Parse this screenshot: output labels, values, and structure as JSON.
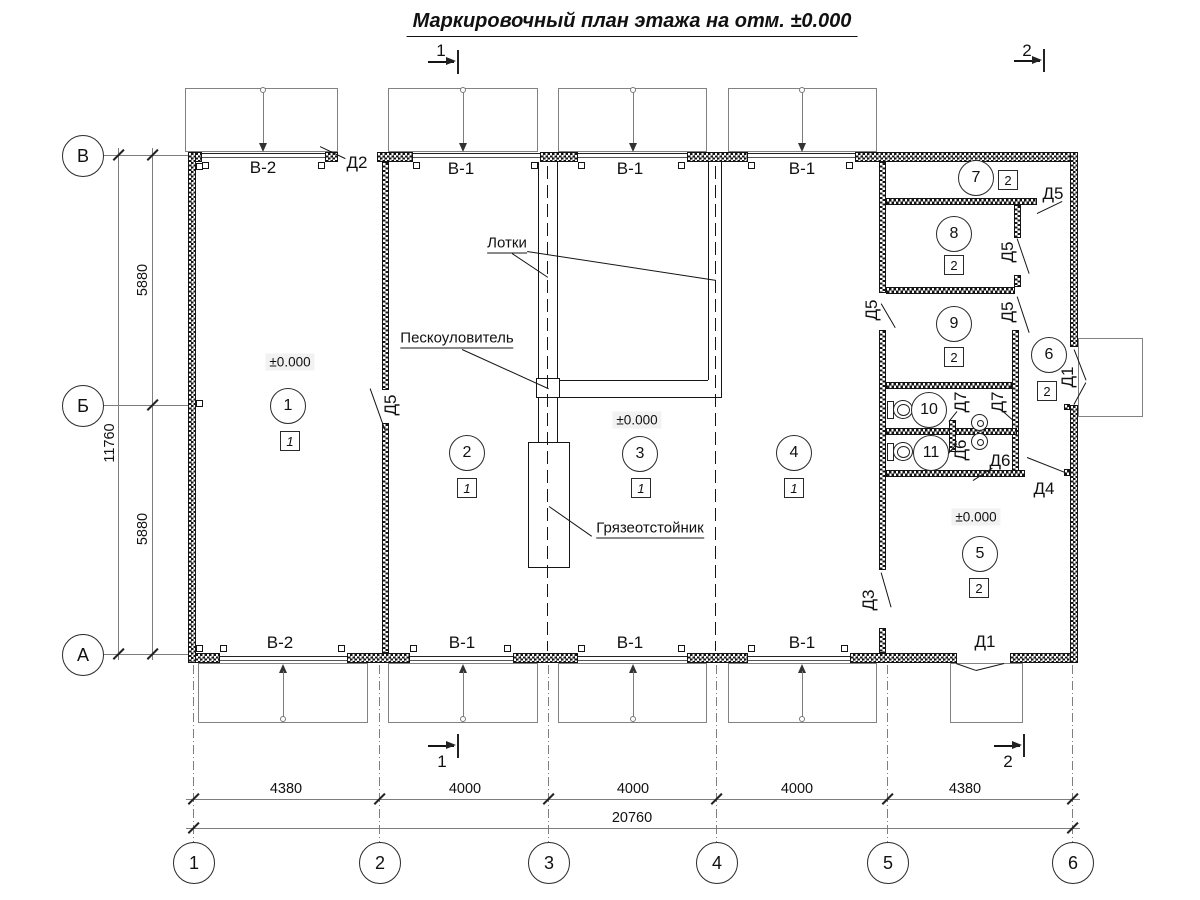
{
  "title": "Маркировочный план этажа на отм. ±0.000",
  "axes": {
    "vertical": [
      "В",
      "Б",
      "А"
    ],
    "horizontal": [
      "1",
      "2",
      "3",
      "4",
      "5",
      "6"
    ]
  },
  "dims": {
    "left": [
      "5880",
      "5880"
    ],
    "left_total": "11760",
    "bottom": [
      "4380",
      "4000",
      "4000",
      "4000",
      "4380"
    ],
    "bottom_total": "20760"
  },
  "rooms": [
    {
      "n": "1",
      "c": "1"
    },
    {
      "n": "2",
      "c": "1"
    },
    {
      "n": "3",
      "c": "1"
    },
    {
      "n": "4",
      "c": "1"
    },
    {
      "n": "5",
      "c": "2"
    },
    {
      "n": "6",
      "c": "2"
    },
    {
      "n": "7",
      "c": "2"
    },
    {
      "n": "8",
      "c": "2"
    },
    {
      "n": "9",
      "c": "2"
    },
    {
      "n": "10"
    },
    {
      "n": "11"
    }
  ],
  "gates": {
    "top": [
      "В-2",
      "В-1",
      "В-1",
      "В-1"
    ],
    "bottom": [
      "В-2",
      "В-1",
      "В-1",
      "В-1"
    ]
  },
  "doors": {
    "d2": "Д2",
    "d5_wall1": "Д5",
    "d5_top_right": "Д5",
    "d5_room8": "Д5",
    "d5_room9_left": "Д5",
    "d5_room9_right": "Д5",
    "d7_a": "Д7",
    "d7_b": "Д7",
    "d6_wc11": "Д6",
    "d6_corridor": "Д6",
    "d4": "Д4",
    "d3": "Д3",
    "d1_right": "Д1",
    "d1_bottom": "Д1"
  },
  "annotations": {
    "trays": "Лотки",
    "sand_trap": "Пескоуловитель",
    "mud_trap": "Грязеотстойник"
  },
  "elevations": {
    "room1": "±0.000",
    "room3": "±0.000",
    "room5": "±0.000"
  },
  "sections": {
    "s1": "1",
    "s2": "2"
  }
}
